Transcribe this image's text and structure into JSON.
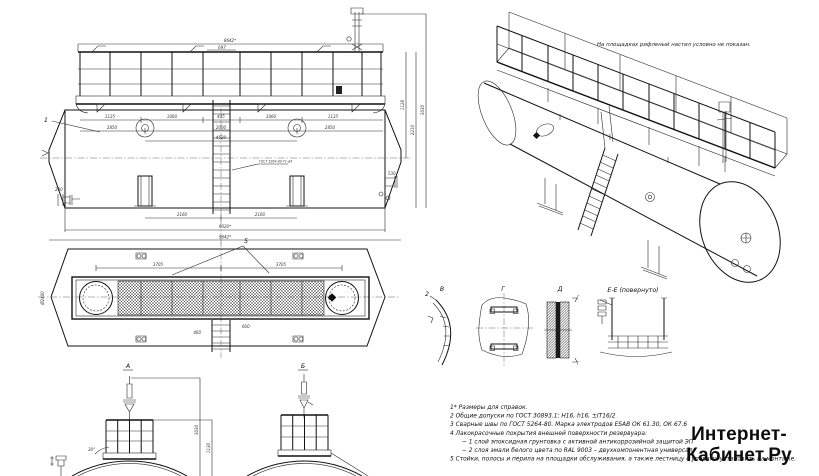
{
  "watermark": {
    "line1": "Интернет-",
    "line2": "Кабинет.Ру"
  },
  "iso_view": {
    "note": "На площадках рифленый настил условно не показан."
  },
  "notes": {
    "lines": [
      "1* Размеры для справок.",
      "2 Общие допуски по ГОСТ 30893.1: Н16, h16, ±IT16/2",
      "3 Сварные швы по ГОСТ 5264-80. Марка электродов ESAB ОК 61.30, ОК 67.6",
      "4 Лакокрасочные покрытия внешней поверхности резервуара:",
      "− 1 слой эпоксидная грунтовка с активной антикоррозийной защитой ЭП",
      "− 2 слоя эмали белого цвета по RAL 9003 – двухкомпонентная универсал",
      "5 Стойки, полосы и перила на площадки обслуживания, а также лестницу с упорами установить на монтаже."
    ]
  },
  "view_labels": {
    "a": "А",
    "b": "Б",
    "v": "В",
    "g": "Г",
    "d": "Д",
    "ee": "Е-Е (повернуто)"
  },
  "callouts": {
    "weld": "ГОСТ 5264-80-Т1-Δ4",
    "item1": "1",
    "item2": "2",
    "item5": "5",
    "sec_g": "Г"
  },
  "dims": {
    "side": [
      "8642*",
      "697",
      "1135",
      "1060",
      "445",
      "1060",
      "1135",
      "2850",
      "2000",
      "2850",
      "4520",
      "2160",
      "2160",
      "9020*",
      "9642*",
      "1128",
      "2210",
      "3030",
      "530",
      "200"
    ],
    "plan": [
      "3705",
      "3705",
      "Ø2400",
      "400",
      "600"
    ],
    "end_a": [
      "3030",
      "1130",
      "30°"
    ]
  },
  "colors": {
    "line": "#2a2a2a",
    "watermark": "#0d0d0d",
    "background": "#ffffff"
  }
}
